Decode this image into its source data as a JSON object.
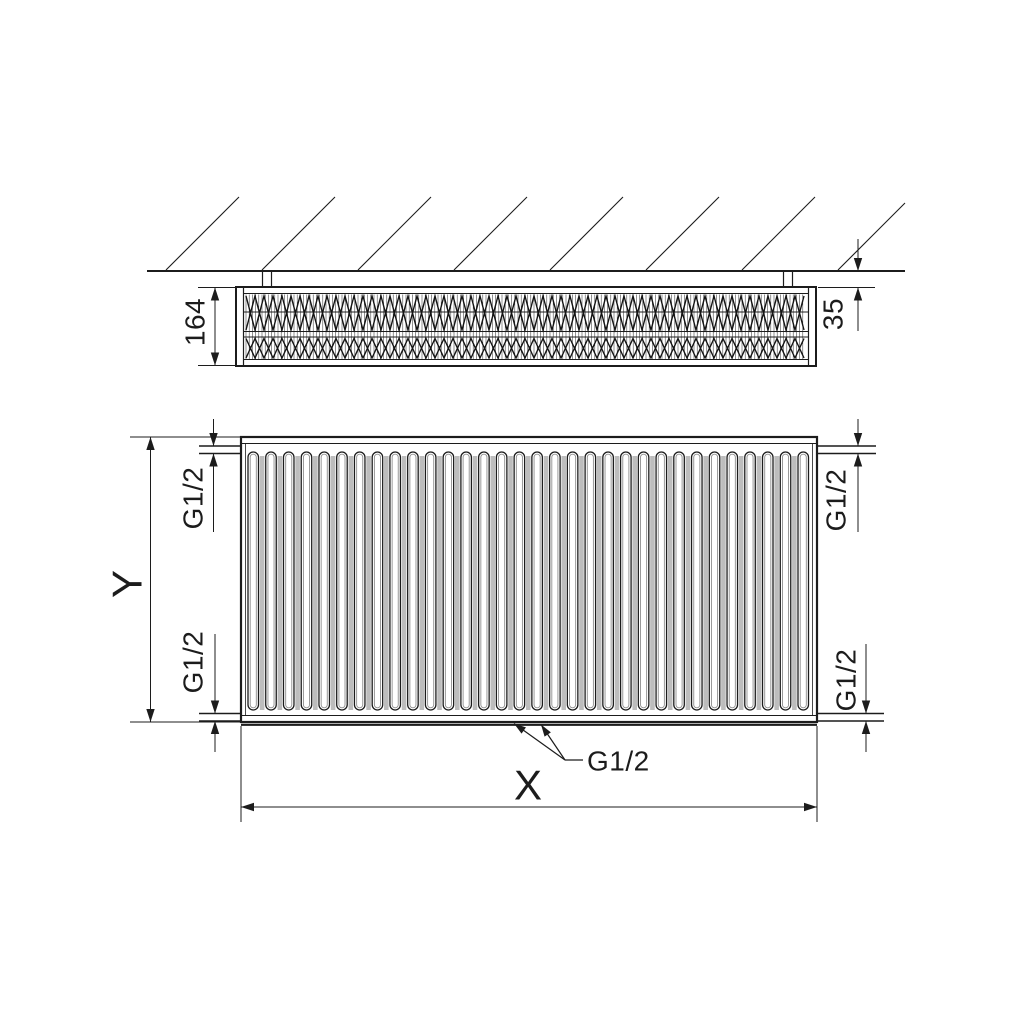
{
  "drawing": {
    "background": "#ffffff",
    "line_color": "#1c1c1c",
    "shading_color": "#bdbdbd"
  },
  "top_view": {
    "depth_label": "164",
    "wall_gap_label": "35"
  },
  "front_view": {
    "height_label": "Y",
    "width_label": "X",
    "conn_top_left_label": "G1/2",
    "conn_top_right_label": "G1/2",
    "conn_bottom_left_label": "G1/2",
    "conn_bottom_right_label": "G1/2",
    "conn_bottom_center_label": "G1/2",
    "slot_count": 32
  }
}
